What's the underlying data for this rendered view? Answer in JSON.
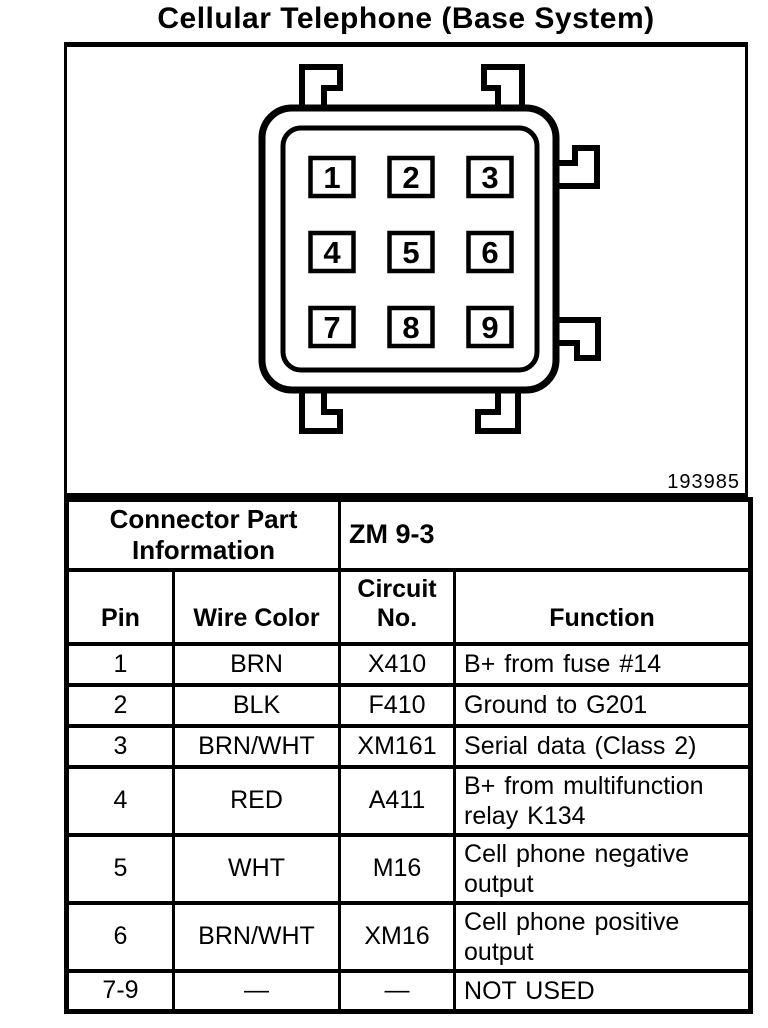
{
  "title": "Cellular Telephone (Base System)",
  "figure_number": "193985",
  "colors": {
    "ink": "#000000",
    "paper": "#ffffff"
  },
  "connector": {
    "pins": [
      "1",
      "2",
      "3",
      "4",
      "5",
      "6",
      "7",
      "8",
      "9"
    ]
  },
  "info": {
    "part_info_label": "Connector Part Information",
    "connector_id": "ZM 9-3"
  },
  "pin_table": {
    "headers": {
      "pin": "Pin",
      "wire_color": "Wire Color",
      "circuit_no": "Circuit No.",
      "function": "Function"
    },
    "rows": [
      {
        "pin": "1",
        "wire_color": "BRN",
        "circuit_no": "X410",
        "function": "B+ from fuse #14"
      },
      {
        "pin": "2",
        "wire_color": "BLK",
        "circuit_no": "F410",
        "function": "Ground to G201"
      },
      {
        "pin": "3",
        "wire_color": "BRN/WHT",
        "circuit_no": "XM161",
        "function": "Serial data (Class 2)"
      },
      {
        "pin": "4",
        "wire_color": "RED",
        "circuit_no": "A411",
        "function": "B+ from multifunction relay K134"
      },
      {
        "pin": "5",
        "wire_color": "WHT",
        "circuit_no": "M16",
        "function": "Cell phone negative output"
      },
      {
        "pin": "6",
        "wire_color": "BRN/WHT",
        "circuit_no": "XM16",
        "function": "Cell phone positive output"
      },
      {
        "pin": "7-9",
        "wire_color": "—",
        "circuit_no": "—",
        "function": "NOT USED"
      }
    ]
  }
}
